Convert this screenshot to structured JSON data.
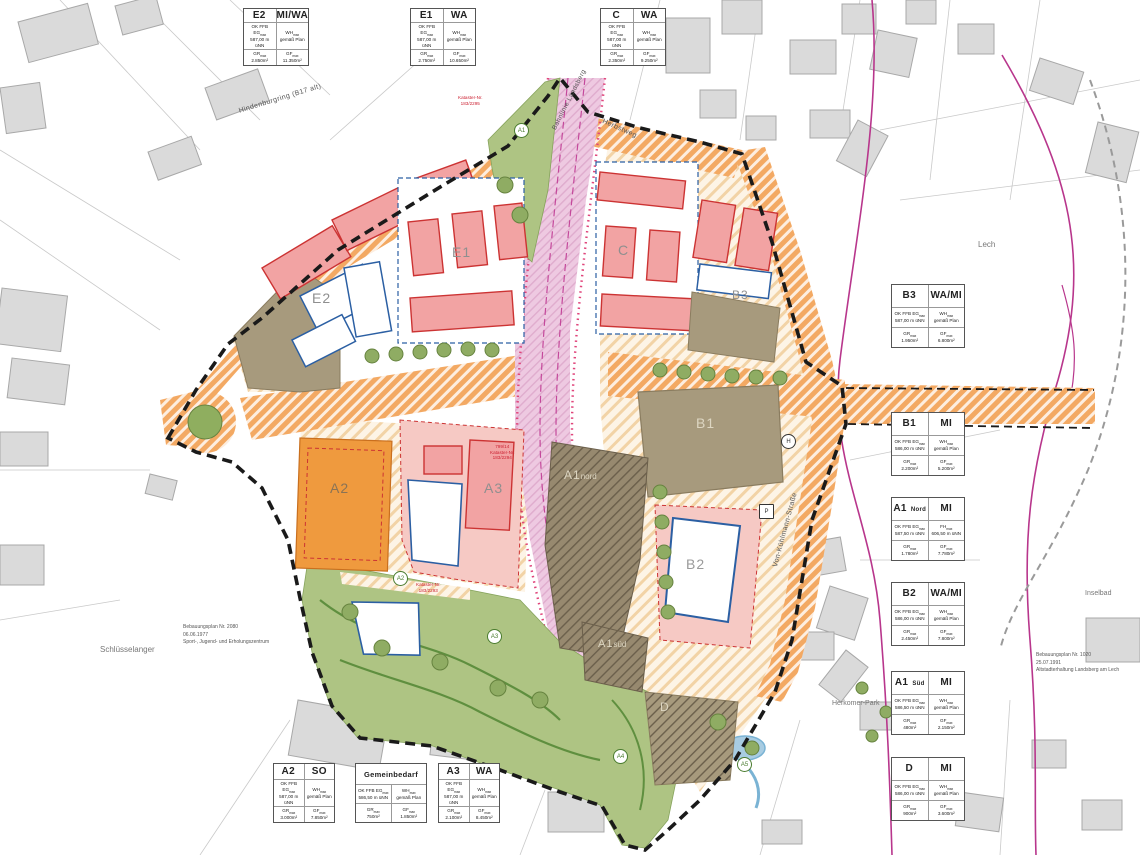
{
  "shared": {
    "ok_label": "OK FFB EG",
    "max": "max",
    "gr_label": "GR",
    "gf_label": "GF"
  },
  "boxes": [
    {
      "id": "E2",
      "suffix": "",
      "type": "MI/WA",
      "elev": "587,00 m üNN",
      "h_label": "WH",
      "h_value": "gemäß Plan",
      "gr": "2.850m²",
      "gf": "11.350m²"
    },
    {
      "id": "E1",
      "suffix": "",
      "type": "WA",
      "elev": "587,00 m üNN",
      "h_label": "WH",
      "h_value": "gemäß Plan",
      "gr": "2.750m²",
      "gf": "10.650m²"
    },
    {
      "id": "C",
      "suffix": "",
      "type": "WA",
      "elev": "587,00 m üNN",
      "h_label": "WH",
      "h_value": "gemäß Plan",
      "gr": "2.350m²",
      "gf": "9.250m²"
    },
    {
      "id": "B3",
      "suffix": "",
      "type": "WA/MI",
      "elev": "587,00 m üNN",
      "h_label": "WH",
      "h_value": "gemäß Plan",
      "gr": "1.950m²",
      "gf": "6.800m²"
    },
    {
      "id": "B1",
      "suffix": "",
      "type": "MI",
      "elev": "586,00 m üNN",
      "h_label": "WH",
      "h_value": "gemäß Plan",
      "gr": "2.200m²",
      "gf": "5.200m²"
    },
    {
      "id": "A1",
      "suffix": "Nord",
      "type": "MI",
      "elev": "587,50 m üNN",
      "h_label": "FH",
      "h_value": "606,50 m üNN",
      "gr": "1.780m²",
      "gf": "7.780m²"
    },
    {
      "id": "B2",
      "suffix": "",
      "type": "WA/MI",
      "elev": "586,00 m üNN",
      "h_label": "WH",
      "h_value": "gemäß Plan",
      "gr": "2.450m²",
      "gf": "7.800m²"
    },
    {
      "id": "A1",
      "suffix": "Süd",
      "type": "MI",
      "elev": "586,50 m üNN",
      "h_label": "WH",
      "h_value": "gemäß Plan",
      "gr": "480m²",
      "gf": "2.150m²"
    },
    {
      "id": "D",
      "suffix": "",
      "type": "MI",
      "elev": "586,00 m üNN",
      "h_label": "WH",
      "h_value": "gemäß Plan",
      "gr": "900m²",
      "gf": "3.600m²"
    },
    {
      "id": "A2",
      "suffix": "",
      "type": "SO",
      "elev": "587,00 m üNN",
      "h_label": "WH",
      "h_value": "gemäß Plan",
      "gr": "3.000m²",
      "gf": "7.850m²"
    },
    {
      "id": "Gemeinbedarf",
      "suffix": "",
      "type": "",
      "elev": "586,50 m üNN",
      "h_label": "WH",
      "h_value": "gemäß Plan",
      "gr": "750m²",
      "gf": "1.850m²"
    },
    {
      "id": "A3",
      "suffix": "",
      "type": "WA",
      "elev": "587,00 m üNN",
      "h_label": "WH",
      "h_value": "gemäß Plan",
      "gr": "2.100m²",
      "gf": "8.450m²"
    }
  ],
  "zones": {
    "e2": "E2",
    "e1": "E1",
    "c": "C",
    "b3": "B3",
    "b1": "B1",
    "b2": "B2",
    "d": "D",
    "a1n": "A1",
    "a1n_sub": "nord",
    "a1s": "A1",
    "a1s_sub": "süd",
    "a2": "A2",
    "a3": "A3"
  },
  "streets": {
    "hindenburgring": "Hindenburgring (B17 alt)",
    "bahnlinie": "Bahnlinie Landsberg",
    "herbstweg": "Herbstweg",
    "von_kuehlmann": "Von-Kühlmann-Straße"
  },
  "places": {
    "lech": "Lech",
    "inselbad": "Inselbad",
    "schluesselanger": "Schlüsselanger",
    "herkomer_park": "Herkomer-Park"
  },
  "notes": {
    "left": {
      "l1": "Bebauungsplan Nr. 2080",
      "l2": "06.06.1977",
      "l3": "Sport-, Jugend- und Erholungszentrum"
    },
    "right": {
      "l1": "Bebauungsplan Nr. 1020",
      "l2": "25.07.1991",
      "l3": "Altstadterhaltung Landsberg am Lech"
    }
  },
  "annotations": {
    "k1_l1": "Kataster-Nr.",
    "k1_l2": "183/2295",
    "k2_l1": "799/14",
    "k2_l2": "Kataster-Nr.",
    "k2_l3": "183/2294",
    "k3_l1": "Kataster-Nr.",
    "k3_l2": "183/2293"
  },
  "markers": {
    "a1": "A1",
    "a2": "A2",
    "a3": "A3",
    "a4": "A4",
    "a5": "A5",
    "h": "H",
    "p": "P"
  },
  "colors": {
    "road_orange": "#f3a963",
    "rail_pink": "#eec9e1",
    "green": "#aec483",
    "brown": "#a79a7d",
    "dark_brown": "#97896f",
    "building_pink": "#f2a3a3",
    "blue_outline": "#2b5fa3",
    "red_line": "#cc3333",
    "magenta": "#b8368c",
    "so_orange": "#ef9a3e"
  }
}
